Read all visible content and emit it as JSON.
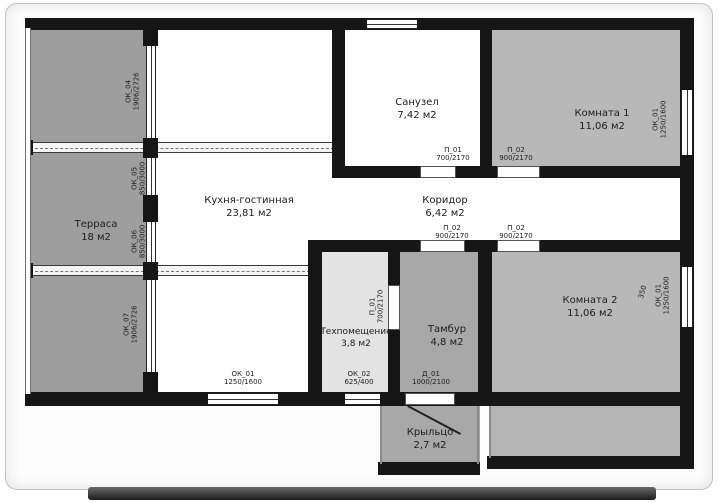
{
  "plan": {
    "colors": {
      "wall": "#161616",
      "paper": "#fcfcfc",
      "terrace_fill": "#9e9e9e",
      "room_fill": "#b8b8b8",
      "tambour_fill": "#a8a8a8",
      "techroom_fill": "#e3e3e3",
      "porch_fill": "#a8a8a8",
      "deck_fill": "#b5b5b5"
    },
    "rooms": [
      {
        "id": "terrace",
        "name": "Терраса",
        "area": "18 м2",
        "fill": "#9e9e9e"
      },
      {
        "id": "kitchen",
        "name": "Кухня-гостинная",
        "area": "23,81 м2",
        "fill": "#ffffff"
      },
      {
        "id": "bathroom",
        "name": "Санузел",
        "area": "7,42 м2",
        "fill": "#ffffff"
      },
      {
        "id": "corridor",
        "name": "Коридор",
        "area": "6,42 м2",
        "fill": "#ffffff"
      },
      {
        "id": "room1",
        "name": "Комната 1",
        "area": "11,06 м2",
        "fill": "#b8b8b8"
      },
      {
        "id": "room2",
        "name": "Комната 2",
        "area": "11,06 м2",
        "fill": "#b8b8b8"
      },
      {
        "id": "techroom",
        "name": "Техпомещение",
        "area": "3,8 м2",
        "fill": "#e3e3e3"
      },
      {
        "id": "tambour",
        "name": "Тамбур",
        "area": "4,8 м2",
        "fill": "#a8a8a8"
      },
      {
        "id": "porch",
        "name": "Крыльцо",
        "area": "2,7 м2",
        "fill": "#a8a8a8"
      }
    ],
    "openings": {
      "ok01_kitchen": {
        "label": "ОК_01",
        "size": "1250/1600"
      },
      "ok02": {
        "label": "ОК_02",
        "size": "625/400"
      },
      "d01": {
        "label": "Д_01",
        "size": "1000/2100"
      },
      "p01_bath": {
        "label": "П_01",
        "size": "700/2170"
      },
      "p02_room1": {
        "label": "П_02",
        "size": "900/2170"
      },
      "p02_hall": {
        "label": "П_02",
        "size": "900/2170"
      },
      "p02_room2": {
        "label": "П_02",
        "size": "900/2170"
      },
      "p01_tech": {
        "label": "П_01",
        "size": "700/2170"
      },
      "ok04": {
        "label": "ОК_04",
        "size": "1906/2726"
      },
      "ok05": {
        "label": "ОК_05",
        "size": "850/3000"
      },
      "ok06": {
        "label": "ОК_06",
        "size": "850/3000"
      },
      "ok07": {
        "label": "ОК_07",
        "size": "1906/2726"
      },
      "ok01_room1": {
        "label": "ОК_01",
        "size": "1250/1600"
      },
      "ok01_room2": {
        "label": "ОК_01",
        "size": "1250/1600"
      },
      "dim_350": {
        "label": "350"
      }
    }
  }
}
